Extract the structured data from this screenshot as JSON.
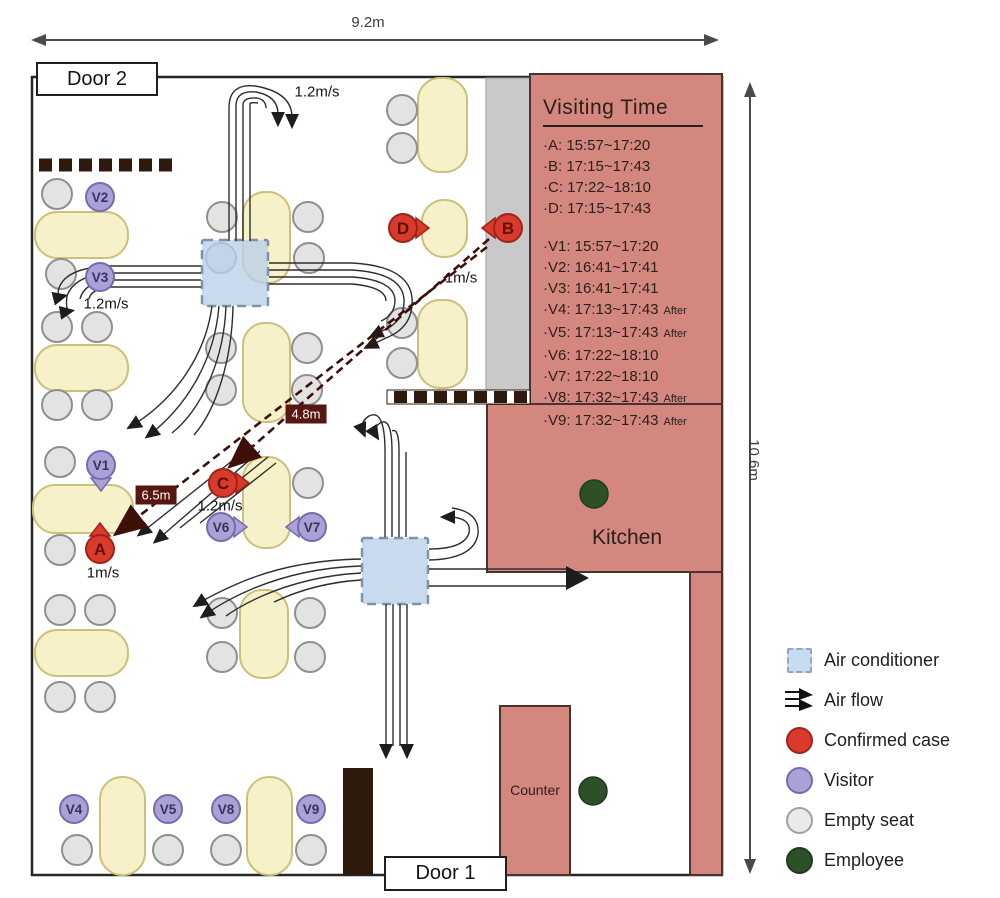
{
  "dimensions": {
    "width_label": "9.2m",
    "height_label": "10.6m"
  },
  "doors": {
    "door2": "Door 2",
    "door1": "Door 1"
  },
  "areas": {
    "kitchen": "Kitchen",
    "counter": "Counter"
  },
  "visiting_time": {
    "title": "Visiting Time",
    "after_suffix": "After",
    "cases": [
      {
        "label": "A",
        "time": "15:57~17:20"
      },
      {
        "label": "B",
        "time": "17:15~17:43"
      },
      {
        "label": "C",
        "time": "17:22~18:10"
      },
      {
        "label": "D",
        "time": "17:15~17:43"
      }
    ],
    "visitors": [
      {
        "label": "V1",
        "time": "15:57~17:20",
        "after": false
      },
      {
        "label": "V2",
        "time": "16:41~17:41",
        "after": false
      },
      {
        "label": "V3",
        "time": "16:41~17:41",
        "after": false
      },
      {
        "label": "V4",
        "time": "17:13~17:43",
        "after": true
      },
      {
        "label": "V5",
        "time": "17:13~17:43",
        "after": true
      },
      {
        "label": "V6",
        "time": "17:22~18:10",
        "after": false
      },
      {
        "label": "V7",
        "time": "17:22~18:10",
        "after": false
      },
      {
        "label": "V8",
        "time": "17:32~17:43",
        "after": true
      },
      {
        "label": "V9",
        "time": "17:32~17:43",
        "after": true
      }
    ]
  },
  "flow_speed_labels": [
    {
      "text": "1.2m/s",
      "x": 317,
      "y": 92
    },
    {
      "text": "1.2m/s",
      "x": 106,
      "y": 304
    },
    {
      "text": "1m/s",
      "x": 461,
      "y": 278
    },
    {
      "text": "1.2m/s",
      "x": 220,
      "y": 506
    },
    {
      "text": "1m/s",
      "x": 103,
      "y": 573
    }
  ],
  "distance_labels": [
    {
      "text": "4.8m",
      "x": 306,
      "y": 414
    },
    {
      "text": "6.5m",
      "x": 156,
      "y": 495
    }
  ],
  "legend": {
    "items": [
      {
        "icon": "air-conditioner-icon",
        "label": "Air conditioner"
      },
      {
        "icon": "air-flow-icon",
        "label": "Air flow"
      },
      {
        "icon": "confirmed-case-icon",
        "label": "Confirmed case"
      },
      {
        "icon": "visitor-icon",
        "label": "Visitor"
      },
      {
        "icon": "empty-seat-icon",
        "label": "Empty seat"
      },
      {
        "icon": "employee-icon",
        "label": "Employee"
      }
    ]
  },
  "markers": {
    "confirmed": [
      {
        "label": "A",
        "x": 100,
        "y": 549,
        "facing": "up"
      },
      {
        "label": "B",
        "x": 508,
        "y": 228,
        "facing": "left"
      },
      {
        "label": "C",
        "x": 223,
        "y": 483,
        "facing": "right"
      },
      {
        "label": "D",
        "x": 403,
        "y": 228,
        "facing": "right"
      }
    ],
    "visitors": [
      {
        "label": "V1",
        "x": 101,
        "y": 465,
        "facing": "down"
      },
      {
        "label": "V2",
        "x": 100,
        "y": 197,
        "facing": null
      },
      {
        "label": "V3",
        "x": 100,
        "y": 277,
        "facing": null
      },
      {
        "label": "V4",
        "x": 74,
        "y": 809,
        "facing": null
      },
      {
        "label": "V5",
        "x": 168,
        "y": 809,
        "facing": null
      },
      {
        "label": "V6",
        "x": 221,
        "y": 527,
        "facing": "right"
      },
      {
        "label": "V7",
        "x": 312,
        "y": 527,
        "facing": "left"
      },
      {
        "label": "V8",
        "x": 226,
        "y": 809,
        "facing": null
      },
      {
        "label": "V9",
        "x": 311,
        "y": 809,
        "facing": null
      }
    ],
    "employees": [
      {
        "x": 594,
        "y": 494
      },
      {
        "x": 593,
        "y": 791
      }
    ]
  },
  "seats": [
    [
      57,
      194
    ],
    [
      61,
      274
    ],
    [
      57,
      327
    ],
    [
      97,
      327
    ],
    [
      57,
      405
    ],
    [
      97,
      405
    ],
    [
      60,
      462
    ],
    [
      60,
      550
    ],
    [
      60,
      610
    ],
    [
      100,
      610
    ],
    [
      60,
      697
    ],
    [
      100,
      697
    ],
    [
      77,
      850
    ],
    [
      168,
      850
    ],
    [
      226,
      850
    ],
    [
      311,
      850
    ],
    [
      222,
      217
    ],
    [
      308,
      217
    ],
    [
      221,
      258
    ],
    [
      309,
      258
    ],
    [
      221,
      348
    ],
    [
      221,
      390
    ],
    [
      307,
      348
    ],
    [
      307,
      390
    ],
    [
      308,
      483
    ],
    [
      222,
      613
    ],
    [
      222,
      657
    ],
    [
      310,
      613
    ],
    [
      310,
      657
    ],
    [
      402,
      110
    ],
    [
      402,
      148
    ],
    [
      402,
      323
    ],
    [
      402,
      363
    ]
  ],
  "tables": [
    [
      35,
      212,
      93,
      46
    ],
    [
      35,
      345,
      93,
      46
    ],
    [
      33,
      485,
      100,
      48
    ],
    [
      35,
      630,
      93,
      46
    ],
    [
      243,
      192,
      47,
      91
    ],
    [
      243,
      323,
      47,
      99
    ],
    [
      243,
      457,
      47,
      91
    ],
    [
      240,
      590,
      48,
      88
    ],
    [
      100,
      777,
      45,
      98
    ],
    [
      247,
      777,
      45,
      98
    ],
    [
      418,
      78,
      49,
      94
    ],
    [
      422,
      200,
      45,
      57
    ],
    [
      418,
      300,
      49,
      88
    ]
  ],
  "colors": {
    "table_fill": "#f6f1c8",
    "table_border": "#cdc07c",
    "seat_fill": "#e3e3e3",
    "seat_border": "#8f8f8f",
    "confirmed": "#d93a2b",
    "confirmed_border": "#9c241b",
    "confirmed_text": "#5e120b",
    "visitor": "#aba1d7",
    "visitor_border": "#756cab",
    "visitor_text": "#37325e",
    "employee": "#2d5029",
    "employee_border": "#1f3a1d",
    "red_area": "#d4877f",
    "red_area_border": "#4a332c",
    "ac_fill": "#c3d8ee",
    "ac_border": "#7e93ab",
    "maroon": "#3f1009",
    "label_box_bg": "#571710",
    "gray_strip": "#c9c9c9",
    "wood_dark": "#2f1b0d",
    "flow_line": "#2e2e2e",
    "dimension_line": "#4a4a4a"
  }
}
